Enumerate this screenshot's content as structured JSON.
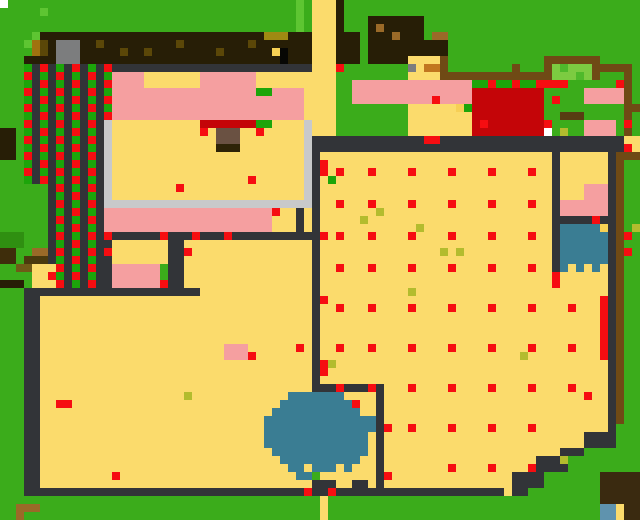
{
  "map": {
    "canvas_w": 640,
    "canvas_h": 520,
    "cell": 8,
    "background": "G",
    "palette": {
      "G": "#3BAC1B",
      "GL": "#5EC532",
      "DGR": "#2F8F11",
      "C": "#1CA50A",
      "L1": "#7CCB41",
      "L2": "#4FB92B",
      "T": "#FBDB6C",
      "TD": "#F6CF56",
      "P": "#F59FA0",
      "R": "#F60D11",
      "DR": "#C40508",
      "D": "#323438",
      "LG": "#C8C9CA",
      "MG": "#7C7D7E",
      "BL": "#271E06",
      "BL2": "#3A2A10",
      "BL3": "#3E2D0B",
      "BK": "#070704",
      "BRN": "#6F4A15",
      "BR2": "#9A6A28",
      "OR": "#C1761F",
      "KH": "#9F8A12",
      "KH2": "#A0720F",
      "OD": "#5B4708",
      "YC": "#F7D154",
      "TB": "#6A5142",
      "TB2": "#2E2307",
      "DK1": "#4A3A0D",
      "DK2": "#6F5A17",
      "DK3": "#573D12",
      "WB": "#3A7D93",
      "SB": "#5F93AE",
      "Y": "#B3BC2E",
      "W": "#FFFFFF"
    },
    "regions": {
      "G": "grass",
      "C": "crops",
      "T": "floor-path",
      "P": "pink-floor",
      "D": "dark-wall",
      "LG": "stone-wall",
      "BL": "tilled-soil",
      "BRN": "fence",
      "DR": "red-building",
      "WB": "water",
      "R": "red-item",
      "Y": "olive-item"
    },
    "rects": [
      [
        "W",
        0,
        0,
        1,
        1
      ],
      [
        "GL",
        5,
        1,
        1,
        1
      ],
      [
        "GL",
        37,
        0,
        1,
        4
      ],
      [
        "T",
        39,
        0,
        3,
        17
      ],
      [
        "BL",
        42,
        0,
        1,
        8
      ],
      [
        "BL",
        43,
        4,
        2,
        4
      ],
      [
        "BL",
        46,
        2,
        7,
        6
      ],
      [
        "BL",
        53,
        5,
        3,
        2
      ],
      [
        "BR2",
        47,
        3,
        1,
        1
      ],
      [
        "BR2",
        49,
        4,
        1,
        1
      ],
      [
        "BR2",
        54,
        4,
        2,
        1
      ],
      [
        "BL",
        5,
        4,
        34,
        4
      ],
      [
        "GL",
        4,
        4,
        1,
        1
      ],
      [
        "GL",
        3,
        5,
        1,
        1
      ],
      [
        "KH2",
        4,
        5,
        1,
        2
      ],
      [
        "OD",
        5,
        5,
        1,
        2
      ],
      [
        "BL",
        3,
        7,
        2,
        1
      ],
      [
        "KH",
        33,
        4,
        3,
        1
      ],
      [
        "YC",
        34,
        6,
        1,
        1
      ],
      [
        "BK",
        35,
        6,
        1,
        2
      ],
      [
        "MG",
        7,
        5,
        3,
        3
      ],
      [
        "OD",
        12,
        5,
        1,
        1
      ],
      [
        "OD",
        15,
        6,
        1,
        1
      ],
      [
        "OD",
        18,
        6,
        1,
        1
      ],
      [
        "OD",
        22,
        5,
        1,
        1
      ],
      [
        "OD",
        27,
        6,
        1,
        1
      ],
      [
        "OD",
        31,
        5,
        1,
        1
      ],
      [
        "D",
        4,
        8,
        35,
        1
      ],
      [
        "D",
        3,
        8,
        11,
        15
      ],
      [
        "D",
        6,
        23,
        7,
        13
      ],
      [
        "LG",
        13,
        15,
        1,
        10
      ],
      [
        "BL",
        0,
        16,
        2,
        4
      ],
      [
        "DGR",
        0,
        29,
        3,
        2
      ],
      [
        "BL3",
        0,
        31,
        2,
        2
      ],
      [
        "BR2",
        4,
        31,
        2,
        1
      ],
      [
        "DK1",
        3,
        32,
        3,
        1
      ],
      [
        "DK2",
        2,
        33,
        2,
        1
      ],
      [
        "T",
        4,
        33,
        3,
        3
      ],
      [
        "BL",
        0,
        35,
        3,
        1
      ],
      [
        "T",
        14,
        9,
        25,
        16
      ],
      [
        "P",
        14,
        9,
        4,
        2
      ],
      [
        "P",
        25,
        9,
        7,
        2
      ],
      [
        "P",
        14,
        11,
        24,
        4
      ],
      [
        "C",
        32,
        11,
        2,
        1
      ],
      [
        "DR",
        25,
        15,
        7,
        1
      ],
      [
        "C",
        32,
        15,
        2,
        1
      ],
      [
        "TB",
        27,
        16,
        3,
        2
      ],
      [
        "TB2",
        27,
        18,
        3,
        1
      ],
      [
        "LG",
        38,
        15,
        1,
        10
      ],
      [
        "LG",
        13,
        25,
        26,
        1
      ],
      [
        "P",
        13,
        26,
        21,
        3
      ],
      [
        "T",
        34,
        27,
        1,
        2
      ],
      [
        "T",
        35,
        26,
        2,
        3
      ],
      [
        "D",
        37,
        26,
        1,
        3
      ],
      [
        "T",
        38,
        26,
        1,
        3
      ],
      [
        "D",
        13,
        29,
        27,
        1
      ],
      [
        "D",
        13,
        30,
        1,
        7
      ],
      [
        "T",
        14,
        30,
        7,
        3
      ],
      [
        "P",
        14,
        33,
        6,
        3
      ],
      [
        "D",
        21,
        30,
        2,
        7
      ],
      [
        "T",
        23,
        30,
        16,
        7
      ],
      [
        "T",
        5,
        37,
        34,
        24
      ],
      [
        "D",
        3,
        36,
        22,
        1
      ],
      [
        "D",
        3,
        36,
        2,
        25
      ],
      [
        "P",
        28,
        43,
        3,
        2
      ],
      [
        "T",
        40,
        19,
        36,
        42
      ],
      [
        "G",
        64,
        62,
        16,
        3
      ],
      [
        "G",
        68,
        59,
        12,
        2
      ],
      [
        "G",
        71,
        56,
        9,
        3
      ],
      [
        "G",
        77,
        53,
        3,
        3
      ],
      [
        "D",
        39,
        17,
        39,
        2
      ],
      [
        "D",
        39,
        19,
        1,
        30
      ],
      [
        "D",
        40,
        48,
        8,
        1
      ],
      [
        "D",
        47,
        49,
        1,
        12
      ],
      [
        "D",
        69,
        18,
        1,
        16
      ],
      [
        "D",
        76,
        17,
        1,
        36
      ],
      [
        "D",
        70,
        27,
        6,
        1
      ],
      [
        "T",
        78,
        17,
        2,
        2
      ],
      [
        "BRN",
        78,
        13,
        2,
        1
      ],
      [
        "BRN",
        78,
        8,
        1,
        9
      ],
      [
        "BRN",
        77,
        19,
        3,
        1
      ],
      [
        "BRN",
        77,
        20,
        1,
        33
      ],
      [
        "P",
        73,
        23,
        3,
        2
      ],
      [
        "P",
        70,
        25,
        6,
        2
      ],
      [
        "WB",
        70,
        28,
        6,
        5
      ],
      [
        "YC",
        75,
        28,
        1,
        1
      ],
      [
        "WB",
        70,
        33,
        1,
        1
      ],
      [
        "WB",
        72,
        33,
        1,
        1
      ],
      [
        "WB",
        74,
        33,
        1,
        1
      ],
      [
        "R",
        75,
        37,
        1,
        8
      ],
      [
        "P",
        44,
        10,
        15,
        3
      ],
      [
        "T",
        51,
        7,
        4,
        3
      ],
      [
        "MG",
        51,
        8,
        1,
        1
      ],
      [
        "OR",
        53,
        8,
        2,
        1
      ],
      [
        "T",
        51,
        13,
        8,
        4
      ],
      [
        "TD",
        57,
        13,
        1,
        1
      ],
      [
        "C",
        58,
        13,
        1,
        1
      ],
      [
        "DR",
        59,
        11,
        9,
        6
      ],
      [
        "W",
        68,
        16,
        1,
        1
      ],
      [
        "P",
        73,
        11,
        5,
        2
      ],
      [
        "P",
        73,
        15,
        4,
        2
      ],
      [
        "DK3",
        70,
        14,
        3,
        1
      ],
      [
        "C",
        59,
        10,
        2,
        1
      ],
      [
        "R",
        61,
        10,
        1,
        1
      ],
      [
        "C",
        62,
        10,
        2,
        1
      ],
      [
        "R",
        64,
        10,
        1,
        1
      ],
      [
        "C",
        65,
        10,
        2,
        1
      ],
      [
        "R",
        67,
        10,
        4,
        1
      ],
      [
        "BRN",
        55,
        7,
        1,
        3
      ],
      [
        "BRN",
        56,
        9,
        13,
        1
      ],
      [
        "BRN",
        64,
        8,
        1,
        1
      ],
      [
        "BRN",
        68,
        7,
        1,
        2
      ],
      [
        "BRN",
        69,
        7,
        6,
        1
      ],
      [
        "L1",
        69,
        8,
        5,
        2
      ],
      [
        "L2",
        70,
        8,
        1,
        1
      ],
      [
        "L2",
        72,
        9,
        1,
        1
      ],
      [
        "BRN",
        74,
        8,
        1,
        2
      ],
      [
        "BRN",
        75,
        8,
        3,
        1
      ],
      [
        "D",
        3,
        61,
        35,
        1
      ],
      [
        "D",
        38,
        61,
        25,
        1
      ],
      [
        "T",
        63,
        61,
        1,
        1
      ],
      [
        "D",
        64,
        61,
        2,
        1
      ],
      [
        "D",
        39,
        60,
        3,
        1
      ],
      [
        "D",
        44,
        60,
        2,
        1
      ],
      [
        "D",
        64,
        59,
        4,
        2
      ],
      [
        "D",
        67,
        57,
        4,
        2
      ],
      [
        "D",
        70,
        56,
        3,
        1
      ],
      [
        "D",
        73,
        54,
        4,
        2
      ],
      [
        "D",
        76,
        53,
        1,
        1
      ],
      [
        "BL2",
        75,
        59,
        5,
        4
      ],
      [
        "SB",
        75,
        63,
        2,
        2
      ],
      [
        "T",
        77,
        63,
        1,
        2
      ],
      [
        "BL2",
        78,
        63,
        2,
        2
      ],
      [
        "BR2",
        2,
        63,
        3,
        1
      ],
      [
        "BR2",
        2,
        64,
        1,
        1
      ],
      [
        "T",
        40,
        62,
        1,
        3
      ]
    ],
    "crop_columns": {
      "cols": [
        {
          "col": 3,
          "from": 8,
          "to": 22,
          "red_parity": 1
        },
        {
          "col": 5,
          "from": 8,
          "to": 22,
          "red_parity": 0
        },
        {
          "col": 7,
          "from": 8,
          "to": 35,
          "red_parity": 1
        },
        {
          "col": 9,
          "from": 8,
          "to": 35,
          "red_parity": 0
        },
        {
          "col": 11,
          "from": 8,
          "to": 35,
          "red_parity": 1
        },
        {
          "col": 13,
          "from": 8,
          "to": 14,
          "red_parity": 0
        }
      ]
    },
    "pond": {
      "color": "WB",
      "rows": [
        {
          "y": 49,
          "spans": [
            [
              36,
              42
            ]
          ]
        },
        {
          "y": 50,
          "spans": [
            [
              35,
              43
            ]
          ]
        },
        {
          "y": 51,
          "spans": [
            [
              34,
              44
            ]
          ]
        },
        {
          "y": 52,
          "spans": [
            [
              33,
              46
            ]
          ]
        },
        {
          "y": 53,
          "spans": [
            [
              33,
              46
            ]
          ]
        },
        {
          "y": 54,
          "spans": [
            [
              33,
              45
            ]
          ]
        },
        {
          "y": 55,
          "spans": [
            [
              33,
              45
            ]
          ]
        },
        {
          "y": 56,
          "spans": [
            [
              34,
              45
            ]
          ]
        },
        {
          "y": 57,
          "spans": [
            [
              35,
              44
            ]
          ]
        },
        {
          "y": 58,
          "spans": [
            [
              36,
              37
            ],
            [
              39,
              41
            ],
            [
              43,
              43
            ]
          ]
        },
        {
          "y": 59,
          "spans": [
            [
              37,
              38
            ]
          ]
        }
      ]
    },
    "dots_colors": {
      "red": "R",
      "olive": "Y",
      "green": "C"
    },
    "dots": {
      "red": [
        [
          42,
          8
        ],
        [
          53,
          17
        ],
        [
          54,
          17
        ],
        [
          25,
          16
        ],
        [
          32,
          16
        ],
        [
          22,
          23
        ],
        [
          31,
          22
        ],
        [
          34,
          26
        ],
        [
          13,
          29
        ],
        [
          20,
          29
        ],
        [
          24,
          29
        ],
        [
          28,
          29
        ],
        [
          13,
          31
        ],
        [
          23,
          31
        ],
        [
          20,
          35
        ],
        [
          6,
          34
        ],
        [
          37,
          43
        ],
        [
          31,
          44
        ],
        [
          7,
          50
        ],
        [
          8,
          50
        ],
        [
          14,
          59
        ],
        [
          38,
          61
        ],
        [
          41,
          61
        ],
        [
          48,
          59
        ],
        [
          54,
          12
        ],
        [
          60,
          15
        ],
        [
          69,
          12
        ],
        [
          68,
          15
        ],
        [
          77,
          10
        ],
        [
          78,
          15
        ],
        [
          78,
          18
        ],
        [
          74,
          27
        ],
        [
          78,
          29
        ],
        [
          78,
          31
        ],
        [
          69,
          34
        ],
        [
          69,
          35
        ],
        [
          73,
          49
        ],
        [
          44,
          50
        ],
        [
          40,
          20
        ],
        [
          40,
          21
        ],
        [
          40,
          29
        ],
        [
          40,
          37
        ],
        [
          40,
          45
        ],
        [
          40,
          46
        ],
        [
          42,
          48
        ],
        [
          46,
          48
        ],
        [
          51,
          48
        ],
        [
          48,
          53
        ],
        [
          51,
          53
        ],
        [
          42,
          21
        ],
        [
          46,
          21
        ],
        [
          51,
          21
        ],
        [
          56,
          21
        ],
        [
          61,
          21
        ],
        [
          66,
          21
        ],
        [
          42,
          25
        ],
        [
          46,
          25
        ],
        [
          51,
          25
        ],
        [
          56,
          25
        ],
        [
          61,
          25
        ],
        [
          66,
          25
        ],
        [
          42,
          29
        ],
        [
          46,
          29
        ],
        [
          51,
          29
        ],
        [
          56,
          29
        ],
        [
          61,
          29
        ],
        [
          66,
          29
        ],
        [
          42,
          33
        ],
        [
          46,
          33
        ],
        [
          51,
          33
        ],
        [
          56,
          33
        ],
        [
          61,
          33
        ],
        [
          66,
          33
        ],
        [
          42,
          38
        ],
        [
          46,
          38
        ],
        [
          51,
          38
        ],
        [
          56,
          38
        ],
        [
          61,
          38
        ],
        [
          66,
          38
        ],
        [
          71,
          38
        ],
        [
          42,
          43
        ],
        [
          46,
          43
        ],
        [
          51,
          43
        ],
        [
          56,
          43
        ],
        [
          61,
          43
        ],
        [
          66,
          43
        ],
        [
          71,
          43
        ],
        [
          56,
          48
        ],
        [
          61,
          48
        ],
        [
          66,
          48
        ],
        [
          71,
          48
        ],
        [
          56,
          53
        ],
        [
          61,
          53
        ],
        [
          66,
          53
        ],
        [
          56,
          58
        ],
        [
          61,
          58
        ],
        [
          66,
          58
        ]
      ],
      "olive": [
        [
          45,
          27
        ],
        [
          47,
          26
        ],
        [
          52,
          28
        ],
        [
          55,
          31
        ],
        [
          57,
          31
        ],
        [
          51,
          36
        ],
        [
          41,
          45
        ],
        [
          65,
          44
        ],
        [
          70,
          57
        ],
        [
          79,
          28
        ],
        [
          23,
          49
        ],
        [
          70,
          16
        ]
      ],
      "green": [
        [
          41,
          22
        ]
      ]
    }
  }
}
